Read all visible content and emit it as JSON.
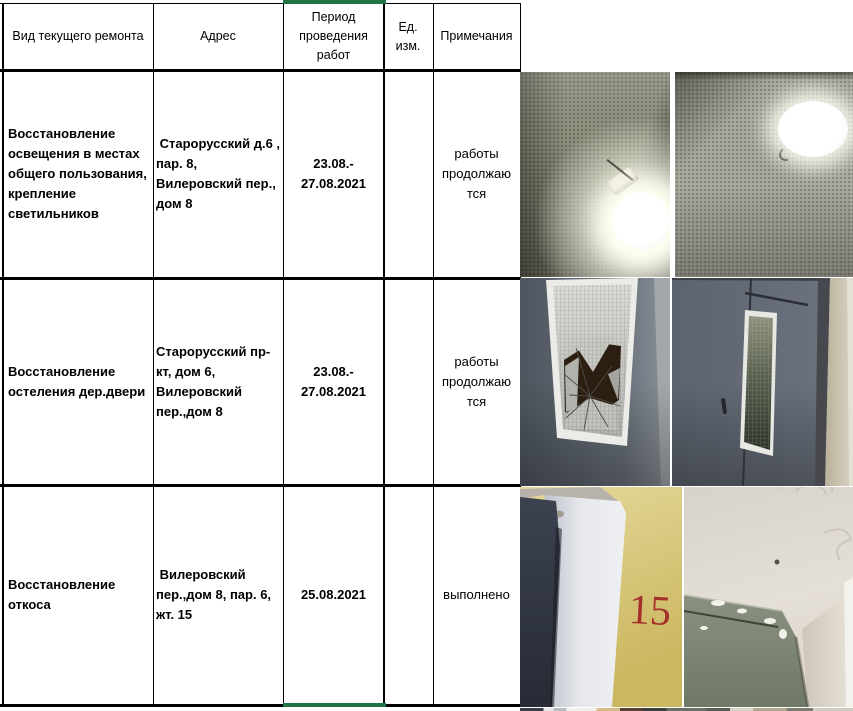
{
  "table": {
    "headers": {
      "type": "Вид текущего ремонта",
      "address": "Адрес",
      "period": "Период\nпроведения\nработ",
      "unit": "Ед.\nизм.",
      "notes": "Примечания"
    },
    "rows": [
      {
        "type": "Восстановление\nосвещения в местах\nобщего пользования,\nкрепление\nсветильников",
        "address": " Старорусский д.6 ,\nпар. 8,\nВилеровский пер.,\nдом 8",
        "period": "23.08.-\n27.08.2021",
        "unit": "",
        "note": "работы\nпродолжаю\nтся"
      },
      {
        "type": "Восстановление\nостеления дер.двери",
        "address": "Старорусский пр-\nкт, дом 6,\nВилеровский\nпер.,дом 8",
        "period": "23.08.-\n27.08.2021",
        "unit": "",
        "note": "работы\nпродолжаю\nтся"
      },
      {
        "type": "Восстановление\nоткоса",
        "address": " Вилеровский\nпер.,дом 8, пар. 6,\nжт. 15",
        "period": "25.08.2021",
        "unit": "",
        "note": "выполнено"
      }
    ]
  },
  "photos": {
    "corner_number": "15",
    "items": [
      "wall-lamp-photo",
      "ceiling-lamp-photo",
      "broken-door-glass-photo",
      "door-with-glass-photo",
      "door-corner-15-photo",
      "ceiling-corner-photo"
    ]
  },
  "colors": {
    "selection_green": "#217346",
    "grid_black": "#000000",
    "number_red": "#a5302b"
  }
}
